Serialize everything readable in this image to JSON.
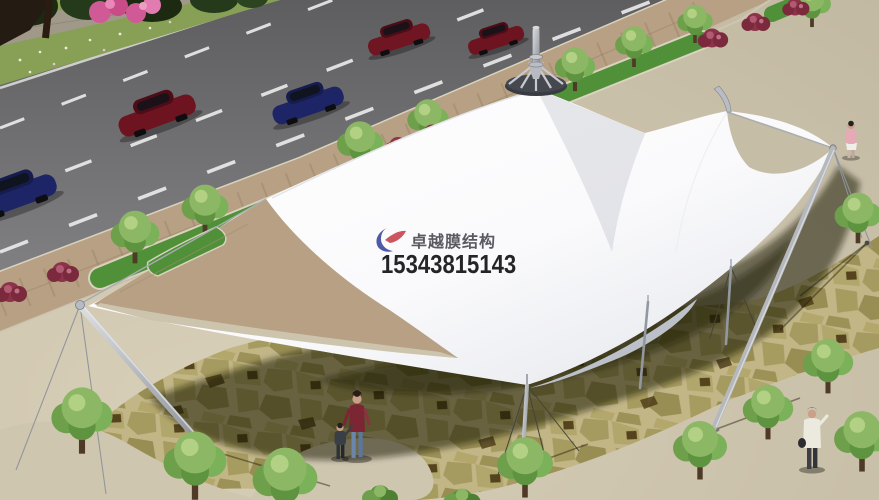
{
  "watermark": {
    "brand": "卓越膜结构",
    "phone": "15343815143",
    "logo_blue": "#2f3f9a",
    "logo_red": "#c43a44",
    "brand_color": "#3f3f46",
    "phone_color": "#0e0e10"
  },
  "palette": {
    "membrane_white": "#ffffff",
    "membrane_shade": "#e2e4ea",
    "road_gray": "#6d6d6f",
    "lane_line": "#ececec",
    "sand_plaza": "#d0c7b0",
    "sidewalk_brick": "#b7a084",
    "median_grass": "#4f9038",
    "flagstone": "#c2b687",
    "stone_khaki": "#a59a5f",
    "canopy_shadow": "rgba(24,21,6,0.52)",
    "tree_foliage": "#8cb764",
    "flower_bush_red": "#8c3349",
    "flower_pink": "#d05a95",
    "car_red": "#6e1420",
    "car_blue": "#1d2566",
    "mast_silver": "#b2b6bc"
  },
  "scene": {
    "cars": [
      "dark-blue",
      "dark-red",
      "dark-blue",
      "dark-red",
      "dark-red"
    ],
    "pedestrians": [
      "woman-with-child",
      "person-with-bag",
      "person-in-pink"
    ],
    "masts": [
      "left-leaning-mast",
      "right-leaning-mast",
      "center-mast",
      "anchor-post-1",
      "anchor-post-2"
    ]
  }
}
